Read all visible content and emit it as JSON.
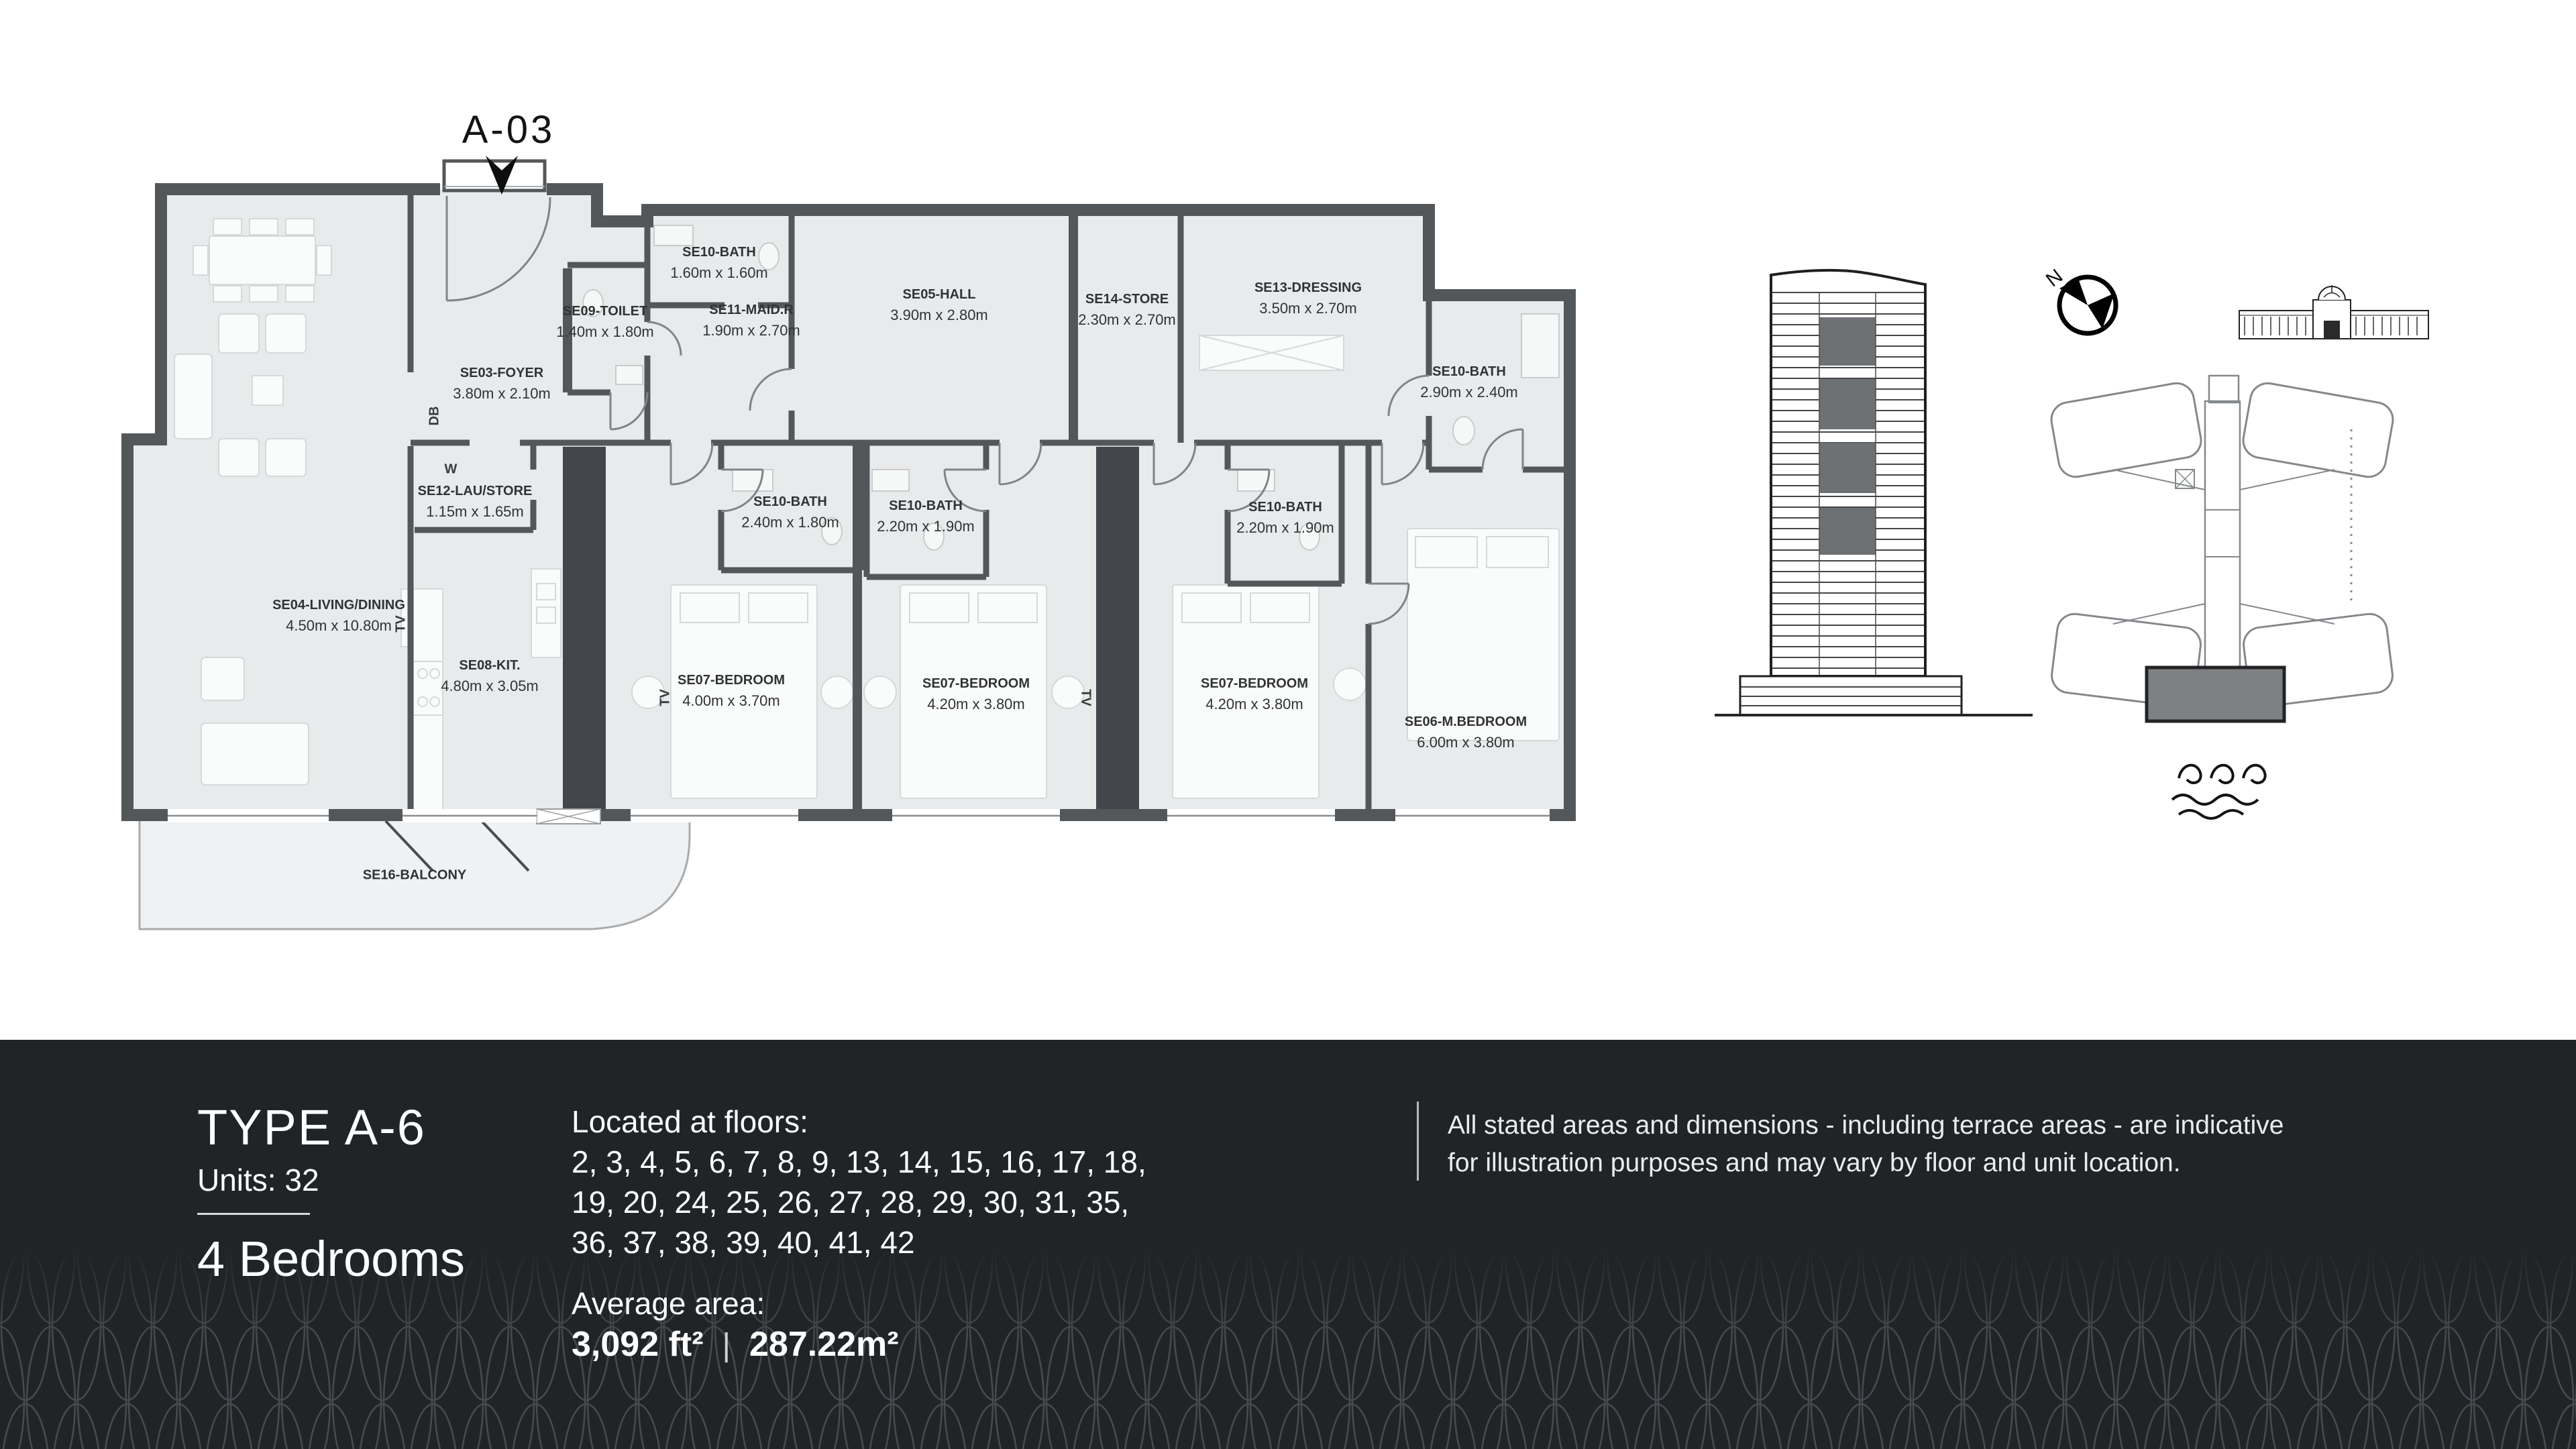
{
  "unit_marker": {
    "label": "A-03"
  },
  "floor_plan": {
    "rooms": [
      {
        "id": "foyer",
        "name": "SE03-FOYER",
        "dims": "3.80m x 2.10m"
      },
      {
        "id": "toilet",
        "name": "SE09-TOILET",
        "dims": "1.40m x 1.80m"
      },
      {
        "id": "bath-maid",
        "name": "SE10-BATH",
        "dims": "1.60m x 1.60m"
      },
      {
        "id": "maid",
        "name": "SE11-MAID.R",
        "dims": "1.90m x 2.70m"
      },
      {
        "id": "hall",
        "name": "SE05-HALL",
        "dims": "3.90m x 2.80m"
      },
      {
        "id": "store",
        "name": "SE14-STORE",
        "dims": "2.30m x 2.70m"
      },
      {
        "id": "dressing",
        "name": "SE13-DRESSING",
        "dims": "3.50m x 2.70m"
      },
      {
        "id": "bath-master",
        "name": "SE10-BATH",
        "dims": "2.90m x 2.40m"
      },
      {
        "id": "laustore",
        "name": "SE12-LAU/STORE",
        "dims": "1.15m x 1.65m"
      },
      {
        "id": "bath1",
        "name": "SE10-BATH",
        "dims": "2.40m x 1.80m"
      },
      {
        "id": "bath2",
        "name": "SE10-BATH",
        "dims": "2.20m x 1.90m"
      },
      {
        "id": "bath3",
        "name": "SE10-BATH",
        "dims": "2.20m x 1.90m"
      },
      {
        "id": "living",
        "name": "SE04-LIVING/DINING",
        "dims": "4.50m x 10.80m"
      },
      {
        "id": "kitchen",
        "name": "SE08-KIT.",
        "dims": "4.80m x 3.05m"
      },
      {
        "id": "bed1",
        "name": "SE07-BEDROOM",
        "dims": "4.00m x 3.70m"
      },
      {
        "id": "bed2",
        "name": "SE07-BEDROOM",
        "dims": "4.20m x 3.80m"
      },
      {
        "id": "bed3",
        "name": "SE07-BEDROOM",
        "dims": "4.20m x 3.80m"
      },
      {
        "id": "master",
        "name": "SE06-M.BEDROOM",
        "dims": "6.00m x 3.80m"
      },
      {
        "id": "balcony",
        "name": "SE16-BALCONY",
        "dims": ""
      }
    ],
    "wall_annotations": [
      {
        "id": "db",
        "label": "DB"
      },
      {
        "id": "w",
        "label": "W"
      },
      {
        "id": "tv1",
        "label": "TV"
      },
      {
        "id": "tv2",
        "label": "TV"
      },
      {
        "id": "tv3",
        "label": "TV"
      }
    ]
  },
  "key_plan": {
    "compass_label": "N"
  },
  "info_panel": {
    "type_title": "TYPE A-6",
    "units_label": "Units: 32",
    "bedrooms": "4 Bedrooms",
    "floors_heading": "Located at floors:",
    "floors_lines": [
      "2, 3, 4, 5, 6, 7, 8, 9, 13, 14, 15, 16, 17, 18,",
      "19, 20, 24, 25, 26, 27, 28, 29, 30, 31, 35,",
      "36, 37, 38, 39, 40, 41, 42"
    ],
    "average_area_heading": "Average area:",
    "area_ft": "3,092 ft²",
    "area_separator": "|",
    "area_m": "287.22m²",
    "disclaimer_lines": [
      "All stated areas and dimensions - including terrace areas - are indicative",
      "for illustration purposes and may vary by floor and unit location."
    ]
  },
  "colors": {
    "bar_bg": "#212427",
    "wall": "#54575a",
    "floor": "#e9eaec",
    "shaft": "#43464a",
    "unit_highlight": "#7e8184",
    "pattern_line": "#474b4f"
  }
}
